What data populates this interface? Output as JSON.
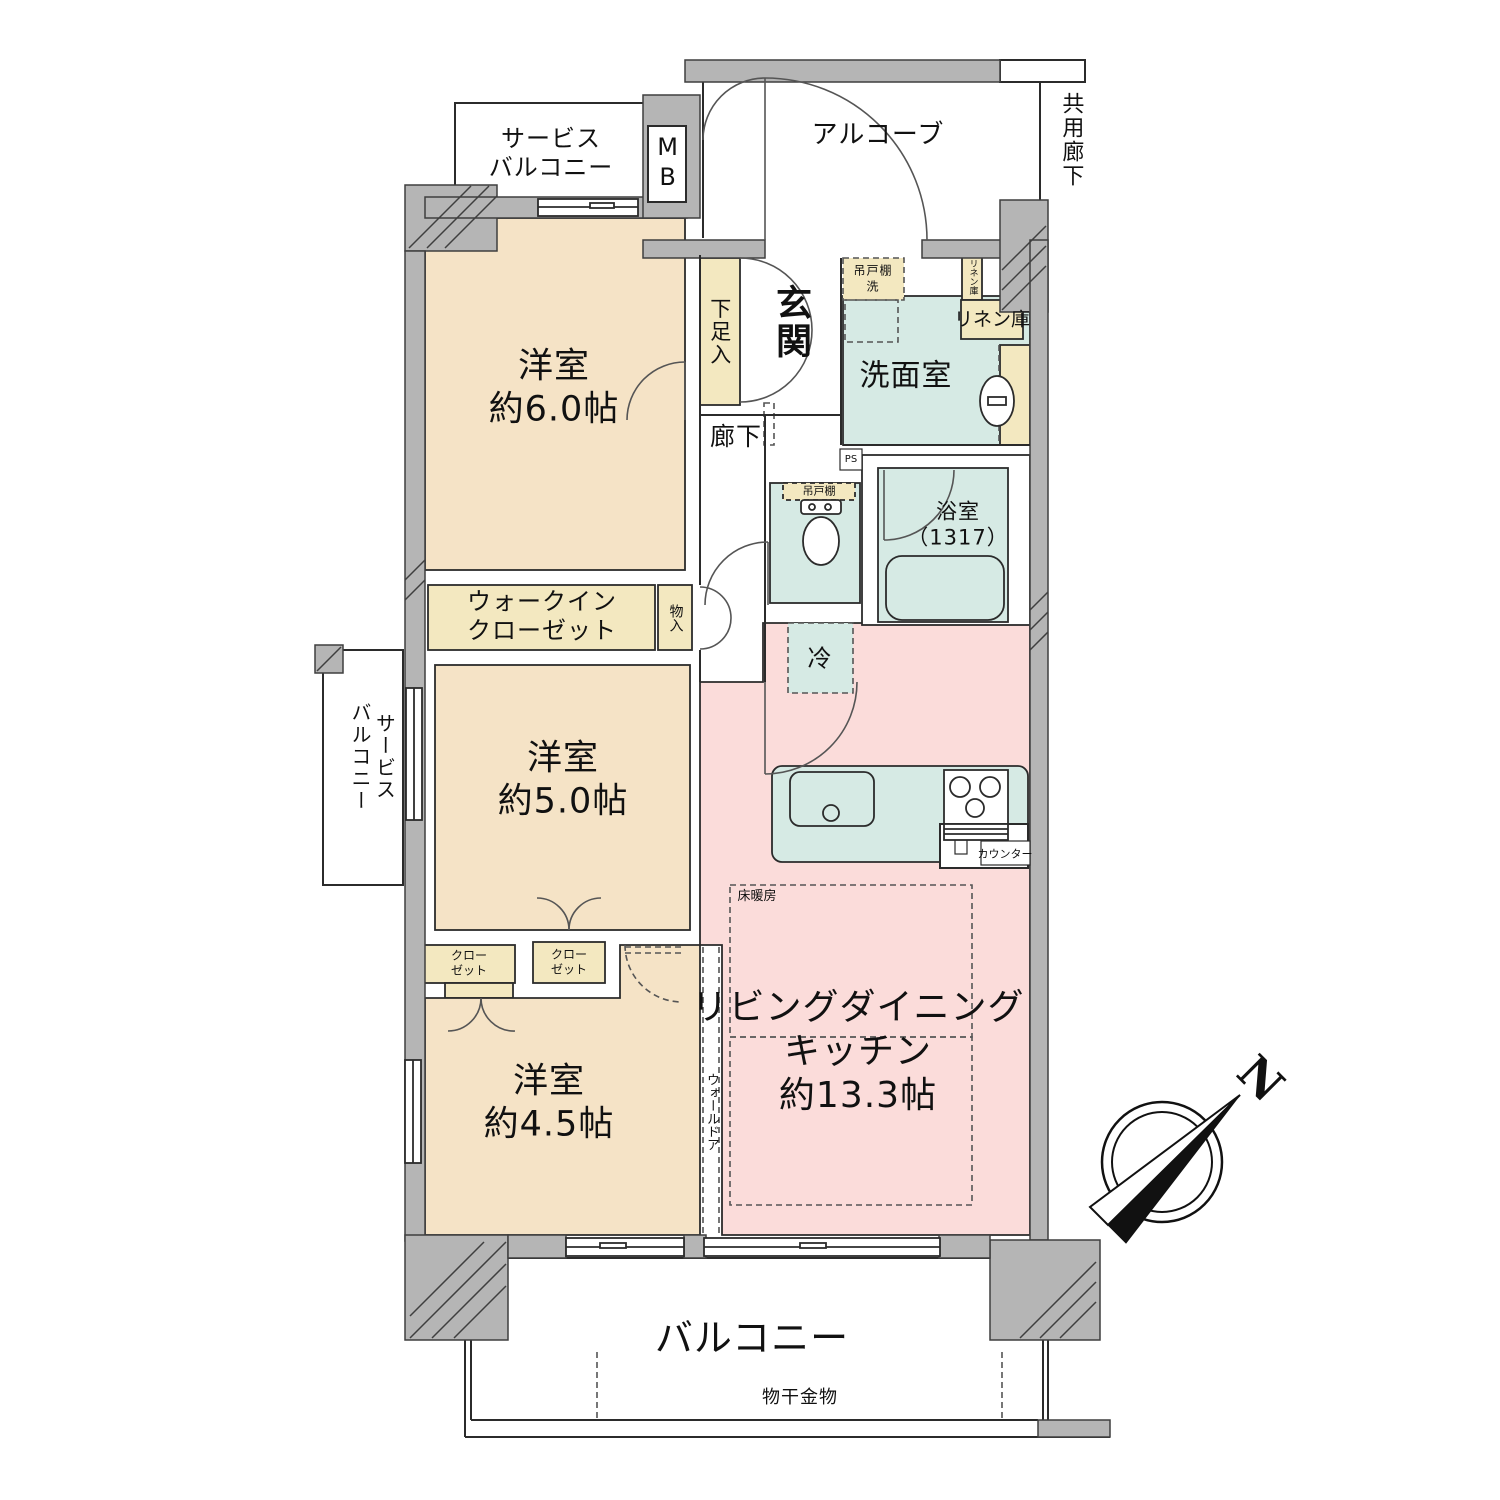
{
  "colors": {
    "room_beige": "#f5e3c6",
    "ldk_pink": "#fbdcda",
    "wet_teal": "#d6eae4",
    "storage_cream": "#f3e8c0",
    "wall_gray": "#b5b5b5"
  },
  "rooms": {
    "bedroom6": {
      "label": "洋室\n約6.0帖"
    },
    "bedroom5": {
      "label": "洋室\n約5.0帖"
    },
    "bedroom45": {
      "label": "洋室\n約4.5帖"
    },
    "ldk": {
      "label": "リビングダイニング\nキッチン\n約13.3帖"
    },
    "entrance": {
      "label": "玄関"
    },
    "hallway": {
      "label": "廊下"
    },
    "washroom": {
      "label": "洗面室"
    },
    "bathroom": {
      "label": "浴室\n（1317）"
    }
  },
  "storage": {
    "shoe_cabinet": "下足入",
    "walk_in_closet": "ウォークイン\nクローゼット",
    "storage_closet": "物入",
    "closet_a": "クロー\nゼット",
    "closet_b": "クロー\nゼット",
    "linen_cabinet": "リネン庫",
    "linen_cabinet_small": "リネン庫",
    "hanging_cupboard_wash": "吊戸棚\n洗",
    "hanging_cupboard_toilet": "吊戸棚"
  },
  "outdoor": {
    "balcony": "バルコニー",
    "service_balcony_top": "サービス\nバルコニー",
    "service_balcony_left": "サービス\nバルコニー",
    "alcove": "アルコーブ",
    "common_corridor": "共用廊下",
    "laundry_hardware": "物干金物"
  },
  "annotations": {
    "mb": "MB",
    "ps": "PS",
    "refrigerator": "冷",
    "floor_heating": "床暖房",
    "counter": "カウンター",
    "wall_door": "ウォールドア",
    "compass_north": "N"
  }
}
